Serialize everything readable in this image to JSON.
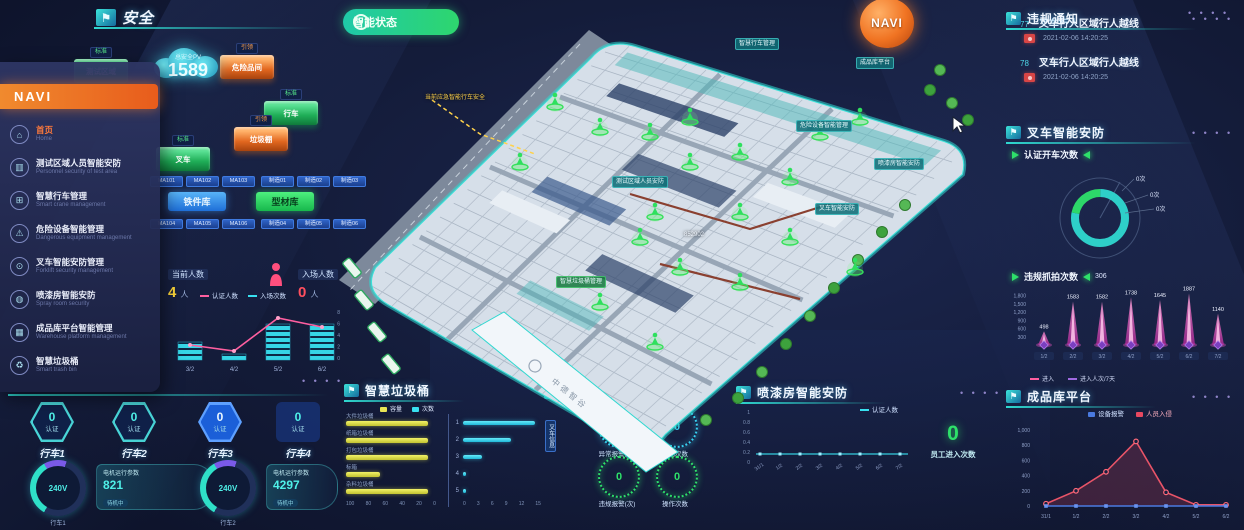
{
  "page": {
    "dots": "• • • •"
  },
  "header": {
    "title": "安全"
  },
  "toolbar": {
    "status_button": "智能状态",
    "navi_sphere": "NAVI"
  },
  "nav_menu": {
    "title": "NAVI",
    "items": [
      {
        "label": "首页",
        "sub": "Home",
        "icon": "home-icon",
        "active": true
      },
      {
        "label": "测试区域人员智能安防",
        "sub": "Personnel security of test area",
        "icon": "people-icon",
        "active": false
      },
      {
        "label": "智慧行车管理",
        "sub": "Smart crane management",
        "icon": "crane-icon",
        "active": false
      },
      {
        "label": "危险设备智能管理",
        "sub": "Dangerous equipment management",
        "icon": "warning-icon",
        "active": false
      },
      {
        "label": "叉车智能安防管理",
        "sub": "Forklift security management",
        "icon": "forklift-icon",
        "active": false
      },
      {
        "label": "喷漆房智能安防",
        "sub": "Spray room security",
        "icon": "spray-icon",
        "active": false
      },
      {
        "label": "成品库平台智能管理",
        "sub": "Warehouse platform management",
        "icon": "warehouse-icon",
        "active": false
      },
      {
        "label": "智慧垃圾桶",
        "sub": "Smart trash bin",
        "icon": "trash-icon",
        "active": false
      }
    ]
  },
  "cloud": {
    "label": "总安全PV",
    "value": "1589"
  },
  "hex_boxes": [
    {
      "tag": "标准",
      "label": "测试区域",
      "color": "g"
    },
    {
      "tag": "引领",
      "label": "危险品间",
      "color": "o"
    },
    {
      "tag": "标准",
      "label": "行车",
      "color": "g"
    },
    {
      "tag": "引领",
      "label": "垃圾棚",
      "color": "o"
    },
    {
      "tag": "标准",
      "label": "叉车",
      "color": "g"
    }
  ],
  "zone_chips": {
    "left_top": [
      "MA101",
      "MA102",
      "MA103"
    ],
    "left_bottom": [
      "MA104",
      "MA105",
      "MA106"
    ],
    "right_top": [
      "制造01",
      "制造02",
      "制造03"
    ],
    "right_bottom": [
      "制造04",
      "制造05",
      "制造06"
    ],
    "blue_button": "铁件库",
    "green_button": "型材库"
  },
  "people_stats": {
    "current_label": "当前人数",
    "current_value": "4",
    "current_unit": "人",
    "entry_label": "入场人数",
    "entry_value": "0",
    "entry_unit": "人"
  },
  "people_chart": {
    "legend": [
      "认证人数",
      "入场次数"
    ],
    "x": [
      "3/2",
      "4/2",
      "5/2",
      "6/2"
    ],
    "bars": [
      3,
      1,
      6,
      6
    ],
    "line": [
      2.5,
      1.5,
      7,
      5.5
    ],
    "ymax": 8,
    "right_axis": [
      "8",
      "6",
      "4",
      "2",
      "0"
    ]
  },
  "crane_panel": {
    "badges": [
      {
        "value": "0",
        "caption": "认证",
        "name": "行车1"
      },
      {
        "value": "0",
        "caption": "认证",
        "name": "行车2"
      },
      {
        "value": "0",
        "caption": "认证",
        "name": "行车3"
      },
      {
        "value": "0",
        "caption": "认证",
        "name": "行车4"
      }
    ],
    "gauges": [
      {
        "value": "240V",
        "name": "行车1",
        "card_title": "电机运行参数",
        "card_value": "821",
        "card_status": "待机中"
      },
      {
        "value": "240V",
        "name": "行车2",
        "card_title": "电机运行参数",
        "card_value": "4297",
        "card_status": "待机中"
      }
    ]
  },
  "trash_panel": {
    "title": "智慧垃圾桶",
    "legend": [
      {
        "label": "容量",
        "color": "#e8e455"
      },
      {
        "label": "次数",
        "color": "#38e0f0"
      }
    ],
    "left": {
      "rows": [
        {
          "label": "大件垃圾桶",
          "value": 95
        },
        {
          "label": "纸箱垃圾桶",
          "value": 95
        },
        {
          "label": "打包垃圾桶",
          "value": 95
        },
        {
          "label": "标箱",
          "value": 40
        },
        {
          "label": "杂料垃圾桶",
          "value": 95
        }
      ],
      "axis": [
        "100",
        "80",
        "60",
        "40",
        "20",
        "0"
      ],
      "max": 100
    },
    "right": {
      "rows": [
        {
          "label": "1",
          "value": 15
        },
        {
          "label": "2",
          "value": 10
        },
        {
          "label": "3",
          "value": 4
        },
        {
          "label": "4",
          "value": 0.6
        },
        {
          "label": "5",
          "value": 0.6
        }
      ],
      "axis": [
        "0",
        "3",
        "6",
        "9",
        "12",
        "15"
      ],
      "max": 15
    }
  },
  "forklift_panel": {
    "title": "叉车设备",
    "rings": [
      {
        "value": "0",
        "label": "异常报警(次)",
        "color": "cyan"
      },
      {
        "value": "0",
        "label": "启动次数",
        "color": "cyan"
      },
      {
        "value": "0",
        "label": "违规报警(次)",
        "color": "green"
      },
      {
        "value": "0",
        "label": "操作次数",
        "color": "green"
      }
    ]
  },
  "spray_panel": {
    "title": "喷漆房智能安防",
    "legend": "认证人数",
    "y_axis": [
      "1",
      "0.8",
      "0.6",
      "0.4",
      "0.2",
      "0"
    ],
    "x": [
      "31/1",
      "1/2",
      "2/2",
      "3/2",
      "4/2",
      "5/2",
      "6/2",
      "7/2"
    ],
    "values": [
      0,
      0,
      0,
      0,
      0,
      0,
      0,
      0
    ],
    "big_value": "0",
    "big_label": "员工进入次数"
  },
  "violation_panel": {
    "title": "违规通知",
    "items": [
      {
        "num": "77",
        "text": "叉车行人区域行人越线",
        "time": "2021-02-06 14:20:25"
      },
      {
        "num": "78",
        "text": "叉车行人区域行人越线",
        "time": "2021-02-06 14:20:25"
      }
    ]
  },
  "forklift_security": {
    "title": "叉车智能安防",
    "metric": "认证开车次数",
    "ring_labels": [
      "0次",
      "0次",
      "0次"
    ],
    "ring_segments": [
      {
        "color": "#2fd8d0",
        "pct": 78
      },
      {
        "color": "#2ee06a",
        "pct": 22
      }
    ]
  },
  "capture_chart": {
    "metric": "违规抓拍次数",
    "badge": "306",
    "y_axis": [
      1800,
      1500,
      1200,
      900,
      600,
      300
    ],
    "y_labels": [
      "1,800",
      "1,500",
      "1,200",
      "900",
      "600",
      "300"
    ],
    "x": [
      "1/2",
      "2/2",
      "3/2",
      "4/2",
      "5/2",
      "6/2",
      "7/2"
    ],
    "values": [
      498,
      1583,
      1582,
      1738,
      1645,
      1887,
      1140
    ],
    "ymax": 1900,
    "legend": [
      "进入",
      "进入人次/7天"
    ]
  },
  "warehouse_panel": {
    "title": "成品库平台",
    "legend": [
      {
        "label": "设备报警",
        "color": "#4a7ae0"
      },
      {
        "label": "人员入侵",
        "color": "#e84860"
      }
    ],
    "y_axis": [
      1000,
      800,
      600,
      400,
      200,
      0
    ],
    "y_labels": [
      "1,000",
      "800",
      "600",
      "400",
      "200",
      "0"
    ],
    "x": [
      "31/1",
      "1/2",
      "2/2",
      "3/2",
      "4/2",
      "5/2",
      "6/2"
    ],
    "series": [
      {
        "name": "人员入侵",
        "color": "#e85468",
        "values": [
          30,
          200,
          450,
          850,
          180,
          15,
          15
        ]
      },
      {
        "name": "设备报警",
        "color": "#4a7ae0",
        "values": [
          0,
          0,
          0,
          0,
          0,
          0,
          0
        ]
      }
    ],
    "ymax": 1000
  },
  "map": {
    "labels": [
      {
        "x": 735,
        "y": 38,
        "text": "智慧行车管理",
        "type": "tag"
      },
      {
        "x": 856,
        "y": 57,
        "text": "成品库平台",
        "type": "tag"
      },
      {
        "x": 796,
        "y": 120,
        "text": "危险设备智能管理",
        "type": "tag"
      },
      {
        "x": 874,
        "y": 158,
        "text": "喷漆房智能安防",
        "type": "tag"
      },
      {
        "x": 612,
        "y": 176,
        "text": "测试区域人员安防",
        "type": "tag"
      },
      {
        "x": 815,
        "y": 203,
        "text": "叉车智能安防",
        "type": "tag"
      },
      {
        "x": 556,
        "y": 276,
        "text": "智慧垃圾桶管理",
        "type": "tag-green"
      },
      {
        "x": 425,
        "y": 92,
        "text": "当前应急智能行车安全",
        "type": "yellow"
      },
      {
        "x": 684,
        "y": 232,
        "text": "852902",
        "type": "plain"
      },
      {
        "x": 545,
        "y": 420,
        "text": "叉车信息",
        "type": "vtag"
      }
    ],
    "road_text": "中德智谷"
  }
}
